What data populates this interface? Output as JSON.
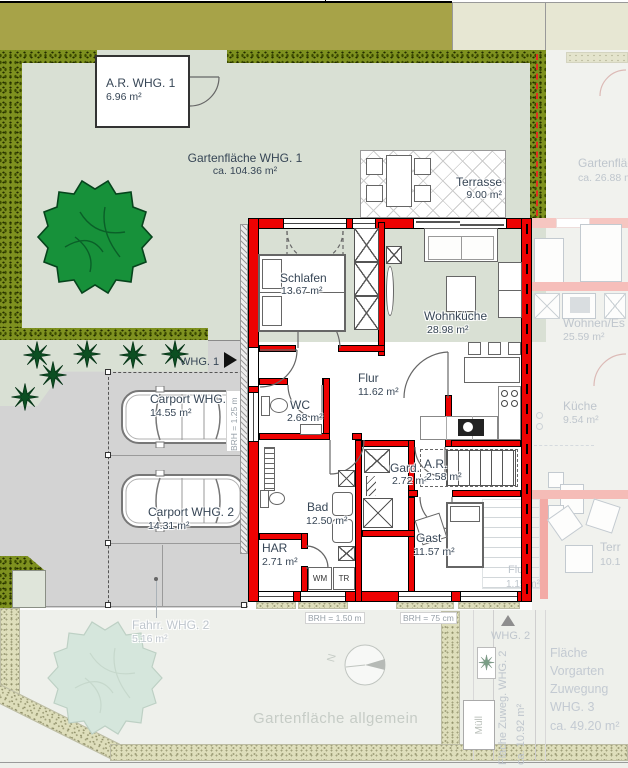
{
  "labels": {
    "shed": {
      "name": "A.R. WHG. 1",
      "area": "6.96 m²"
    },
    "garden1": {
      "name": "Gartenfläche WHG. 1",
      "area": "ca. 104.36 m²"
    },
    "terrasse": {
      "name": "Terrasse",
      "area": "9.00 m²"
    },
    "garden2": {
      "name": "Gartenfläc",
      "area": "ca. 26.88 m"
    },
    "rooms": {
      "schlafen": {
        "name": "Schlafen",
        "area": "13.67 m²"
      },
      "wohnkueche": {
        "name": "Wohnküche",
        "area": "28.98 m²"
      },
      "flur": {
        "name": "Flur",
        "area": "11.62 m²"
      },
      "wc": {
        "name": "WC",
        "area": "2.68 m²"
      },
      "gard": {
        "name": "Gard.",
        "area": "2.72 m²"
      },
      "ar": {
        "name": "A.R.",
        "area": "2.58 m²"
      },
      "bad": {
        "name": "Bad",
        "area": "12.50 m²"
      },
      "har": {
        "name": "HAR",
        "area": "2.71 m²"
      },
      "gast": {
        "name": "Gast",
        "area": "11.57 m²"
      }
    },
    "wm": "WM",
    "tr": "TR",
    "carport1": {
      "name": "Carport WHG. 1",
      "area": "14.55 m²"
    },
    "carport2": {
      "name": "Carport WHG. 2",
      "area": "14.31 m²"
    },
    "entrance1": "WHG. 1",
    "entrance2": "WHG. 2",
    "brh_left": "BRH = 1.25 m",
    "brh_bottom1": "BRH = 1.50 m",
    "brh_bottom2": "BRH = 75 cm",
    "fahrrad": {
      "name": "Fahrr. WHG. 2",
      "area": "5.16 m²"
    },
    "garden_common": "Gartenfläche allgemein",
    "zuweg2": {
      "name": "Fläche Zuweg. WHG. 2",
      "area": "ca. 10.92 m²"
    },
    "vorgarten3": {
      "line1": "Fläche Vorgarten",
      "line2": "Zuwegung",
      "line3": "WHG. 3",
      "line4": "ca. 49.20 m²"
    },
    "muell": "Müll",
    "neighbor": {
      "wohnen": {
        "name": "Wohnen/Es",
        "area": "25.59 m²"
      },
      "kueche": {
        "name": "Küche",
        "area": "9.54 m²"
      },
      "terr": {
        "name": "Terr",
        "area": "10.1"
      },
      "flur": {
        "name": "Flur",
        "area": "1.15 m²"
      }
    },
    "compass_north": "N"
  },
  "colors": {
    "wall_red": "#ee0202",
    "hedge_green": "#7e911f",
    "garden_green": "#d9e0d4",
    "band_olive": "#a7a348",
    "driveway_gray": "#d3d3d3",
    "label_text": "#374656",
    "faded_text": "#bfc6cd"
  }
}
